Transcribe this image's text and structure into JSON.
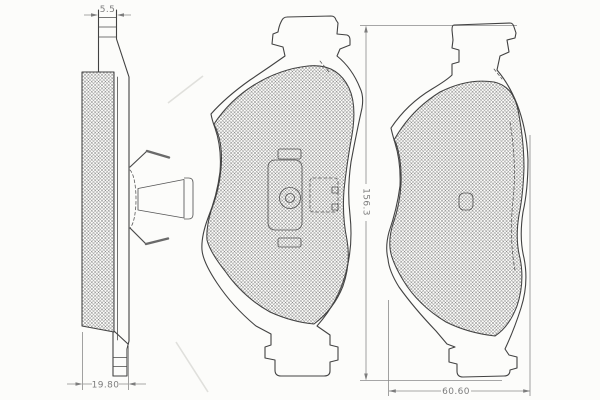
{
  "drawing": {
    "dimensions": {
      "tab_thickness": "5.5",
      "total_thickness": "19.80",
      "pad_height": "156.3",
      "pad_width": "60.60"
    },
    "colors": {
      "outline": "#424242",
      "dimension_lines": "#8a8a8a",
      "label_text": "#7d7d7d",
      "hatch": "#636363",
      "background": "#fcfcfa"
    }
  }
}
